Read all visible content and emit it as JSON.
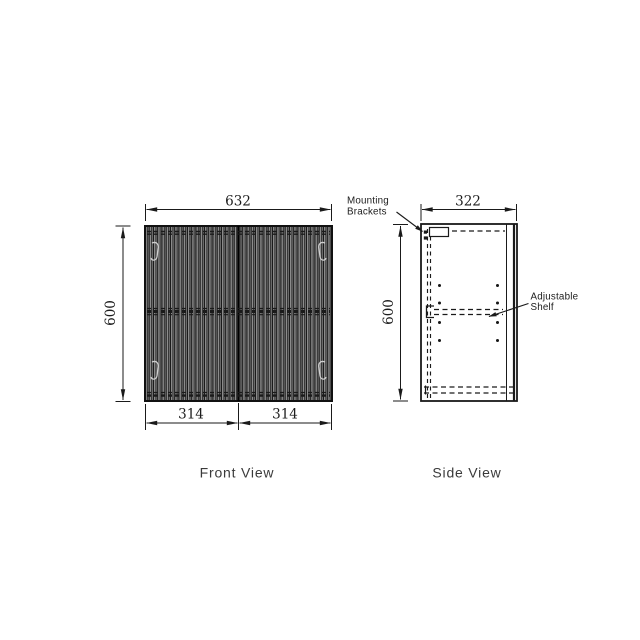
{
  "drawing": {
    "front_view": {
      "title": "Front View",
      "dim_width": "632",
      "dim_height": "600",
      "dim_door_left": "314",
      "dim_door_right": "314"
    },
    "side_view": {
      "title": "Side View",
      "dim_depth": "322",
      "dim_height": "600",
      "annotations": {
        "mounting_brackets_line1": "Mounting",
        "mounting_brackets_line2": "Brackets",
        "adjustable_shelf_line1": "Adjustable",
        "adjustable_shelf_line2": "Shelf"
      }
    },
    "colors": {
      "line": "#1a1a1a",
      "background": "#ffffff",
      "panel_dark": "#161616",
      "panel_light": "#8f8f8f"
    }
  }
}
